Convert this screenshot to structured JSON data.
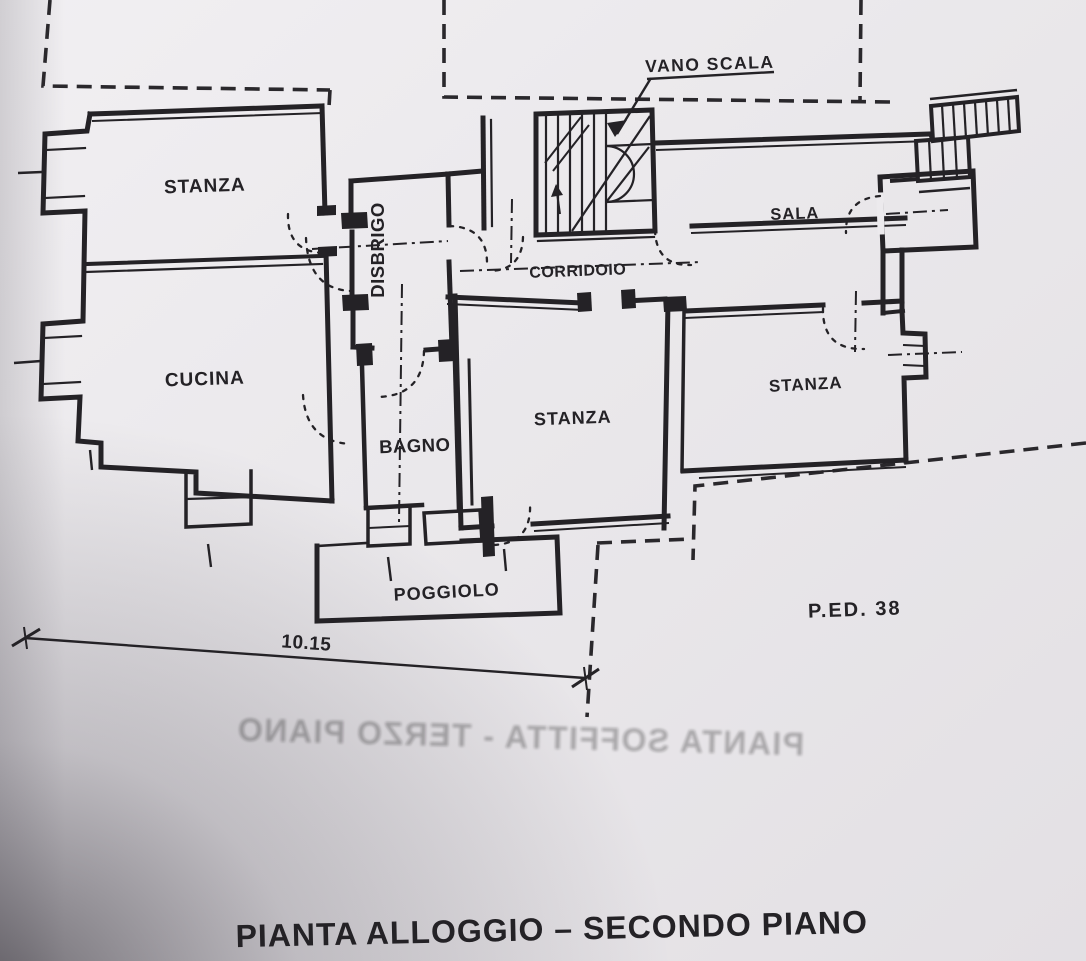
{
  "document": {
    "title": "PIANTA ALLOGGIO – SECONDO PIANO",
    "parcel_label": "P.ED. 38",
    "dimension_label": "10.15",
    "stairwell_label": "VANO SCALA",
    "bleedthrough_text": "PIANTA SOFFITTA - TERZO PIANO"
  },
  "rooms": {
    "stanza_top_left": "STANZA",
    "cucina": "CUCINA",
    "disbrigo": "DISBRIGO",
    "bagno": "BAGNO",
    "stanza_center": "STANZA",
    "corridoio": "CORRIDOIO",
    "sala": "SALA",
    "stanza_right": "STANZA",
    "poggiolo": "POGGIOLO"
  },
  "colors": {
    "ink": "#242226",
    "paper": "#eceaed"
  }
}
